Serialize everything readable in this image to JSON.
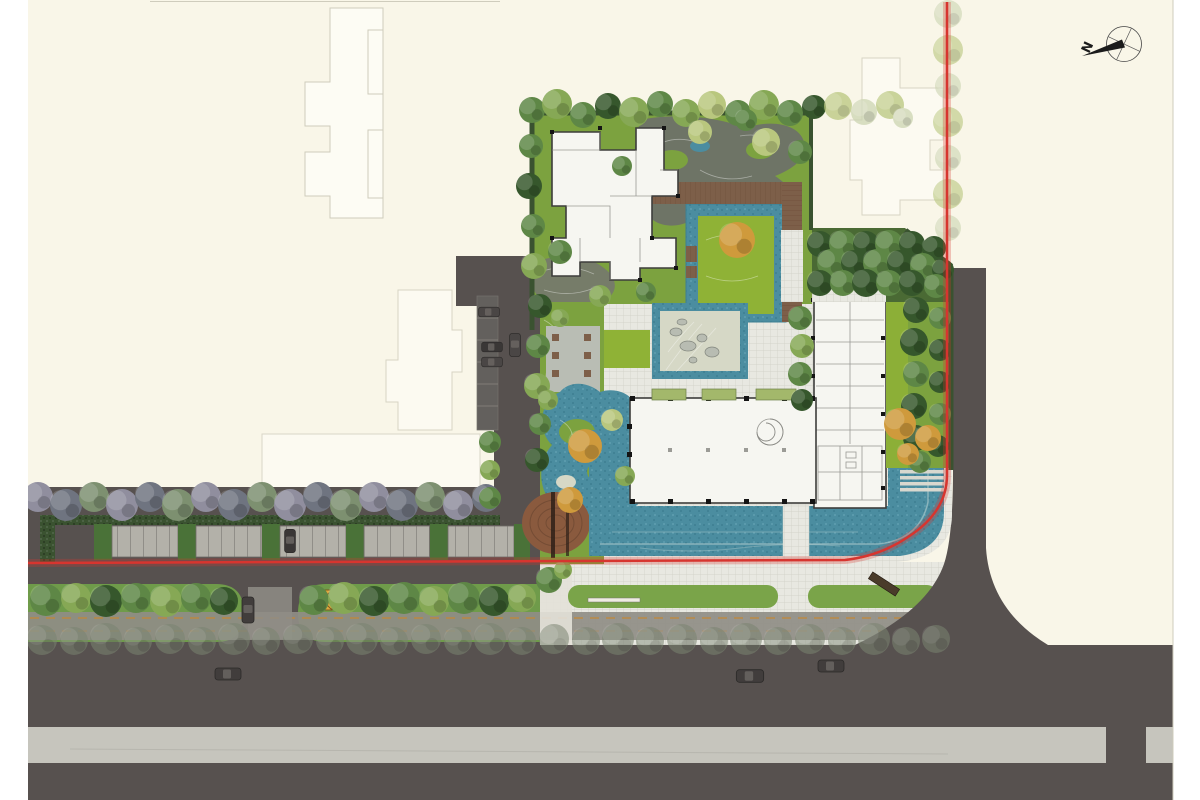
{
  "compass": {
    "label": "N"
  },
  "colors": {
    "paper": "#ffffff",
    "sheet": "#f9f6e8",
    "ghost": "#cfccbc",
    "gfill": "#fdfcf4",
    "road": "#57514f",
    "rlight": "#c6c5bd",
    "rline": "#b3b2aa",
    "red": "#d7352f",
    "grid": "#e8e8e1",
    "gline": "#cfcfc5",
    "walk": "#8f8d86",
    "dash": "#c9872e",
    "water": "#4b8da0",
    "wdark": "#3e7f92",
    "wlight": "#68a7b5",
    "lawn": "#8fb236",
    "green": "#7ca23f",
    "gdark": "#4a6a34",
    "hedge": "#3a5230",
    "island": "#7aa449",
    "median": "#6f9b4a",
    "tG": "#5e8746",
    "tGL": "#86a855",
    "tD": "#36572c",
    "tF": "#7a8471",
    "tP": "#908e9e",
    "tPD": "#6f7480",
    "tM": "#7d9070",
    "tO": "#cf9a3c",
    "tL": "#b9c77e",
    "tPale": "#ccd5b2",
    "wood": "#7d5f49",
    "wood2": "#66432e",
    "deckR": "#8a5a3e",
    "bldg": "#f6f6f1",
    "wall": "#3d3d3b",
    "det": "#8a8a85",
    "col": "#141414",
    "terr": "#b9bdb4",
    "sand": "#d6d8c6",
    "rock": "#b8bcb2",
    "redge": "#83877e",
    "rockbed": "#6e7268",
    "pathblob": "#75786e",
    "stall": "#b3b1a9",
    "sline": "#6e6b66",
    "sgreen": "#4a7238",
    "bench": "#efece2",
    "bdark": "#4a3b2a",
    "ubox": "#dda83e",
    "uline": "#7a5b20",
    "car": "#413d3c",
    "compass": "#1b1b1b"
  },
  "features": [
    "north-compass",
    "property-red-line",
    "main-building",
    "office-wing",
    "clubhouse",
    "formal-pool",
    "pool-lawn-island",
    "zen-garden",
    "natural-pond",
    "round-wood-deck",
    "timber-boardwalk",
    "reflecting-water-plaza",
    "northeast-forest",
    "east-lawn-garden",
    "perpendicular-parking-row",
    "internal-drive",
    "boulevard-median",
    "sidewalk-cycle-path",
    "main-road",
    "side-road",
    "ghost-building-outlines",
    "street-tree-rows",
    "pedestrian-crossings",
    "median-bench",
    "utility-box",
    "cars"
  ]
}
